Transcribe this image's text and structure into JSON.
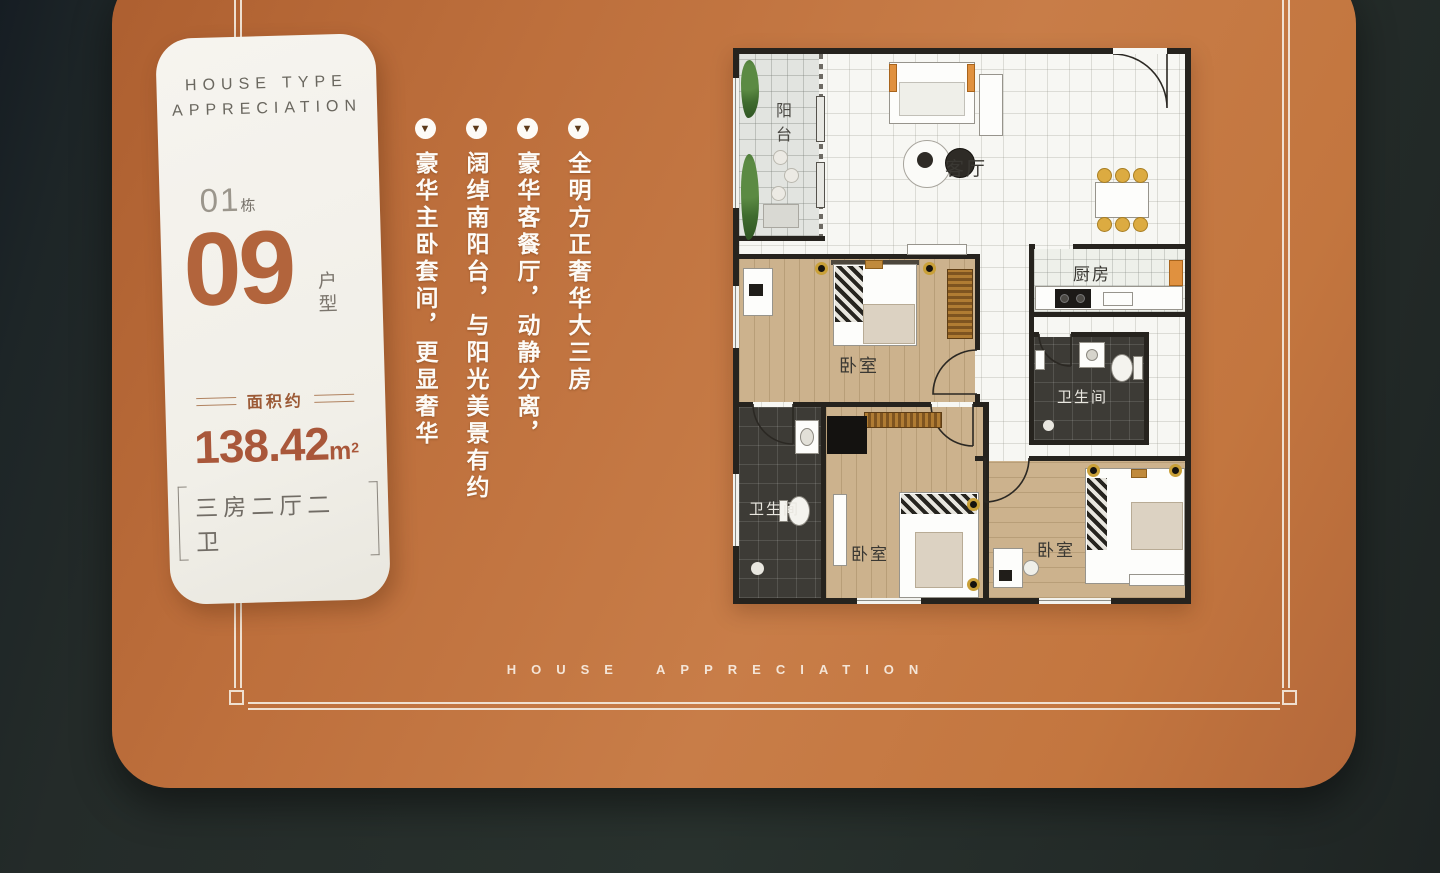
{
  "panel": {
    "header_line1": "HOUSE TYPE",
    "header_line2": "APPRECIATION",
    "building_no": "01",
    "building_suffix": "栋",
    "unit_no": "09",
    "unit_suffix": "户型",
    "area_label": "面积约",
    "area_value": "138.42",
    "area_unit": "m",
    "area_sup": "2",
    "layout_label": "三房二厅二卫"
  },
  "features": [
    "全明方正奢华大三房",
    "豪华客餐厅，动静分离，",
    "阔绰南阳台，与阳光美景有约",
    "豪华主卧套间，更显奢华"
  ],
  "bullets": {
    "icon": "▼"
  },
  "floorplan": {
    "rooms": [
      {
        "name": "balcony",
        "label": "阳台"
      },
      {
        "name": "living-room",
        "label": "客厅"
      },
      {
        "name": "kitchen",
        "label": "厨房"
      },
      {
        "name": "bathroom-right",
        "label": "卫生间"
      },
      {
        "name": "bedroom-master",
        "label": "卧室"
      },
      {
        "name": "bathroom-left",
        "label": "卫生间"
      },
      {
        "name": "bedroom-middle",
        "label": "卧室"
      },
      {
        "name": "bedroom-right",
        "label": "卧室"
      }
    ]
  },
  "footer": {
    "text": "HOUSE APPRECIATION"
  },
  "colors": {
    "card_orange": "#bf7140",
    "terracotta": "#b2643c",
    "background_dark": "#242b29",
    "panel_white": "#f3f1ea",
    "wood_floor": "#ccb28d",
    "dark_tile": "#3d3b36",
    "accent_gold": "#c9a038",
    "accent_orange_furniture": "#e0913f"
  }
}
